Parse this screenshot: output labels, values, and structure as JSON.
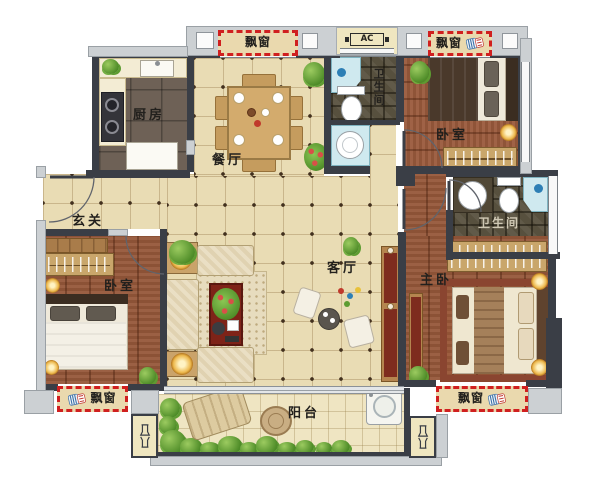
{
  "floor_plan": {
    "labels": {
      "kitchen": "厨房",
      "dining_room": "餐厅",
      "entry_hall": "玄关",
      "living_room": "客厅",
      "bedroom": "卧室",
      "master_bedroom": "主卧",
      "bathroom": "卫生间",
      "balcony": "阳台",
      "bay_window": "飘窗",
      "ac_platform": "AC"
    },
    "colors": {
      "wall_dark": "#3a3e46",
      "trim_gray": "#ccd0d3",
      "tile_cream": "#e9dcb4",
      "wood_brown": "#96583a",
      "bathroom_tile": "#57503e",
      "balcony_tile": "#efe5c2",
      "bay_window_border": "#d01f1f",
      "shower_cyan": "#cfe9ef",
      "greenery": "#5f9c31",
      "coffee_table_red": "#7e2318"
    }
  }
}
